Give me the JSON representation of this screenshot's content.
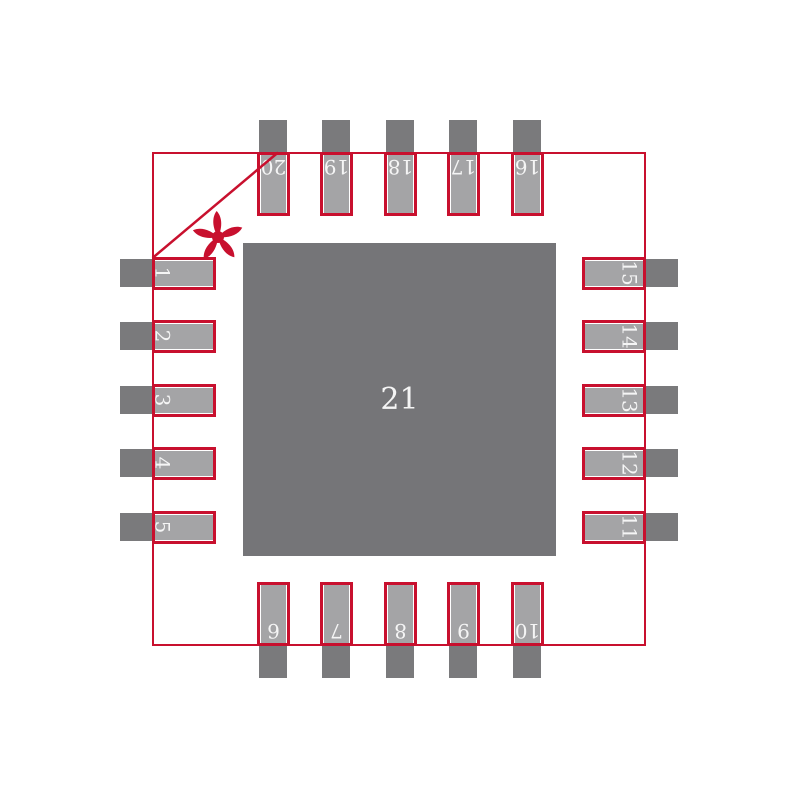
{
  "colors": {
    "accent_red": "#C8102E",
    "pad_fill": "#A4A4A6",
    "copper_dark": "#7A7A7C",
    "thermal_pad_fill": "#757578",
    "pad_number_text": "#F5F5F5",
    "background": "#FFFFFF"
  },
  "center_pad": {
    "label": "21"
  },
  "pin1_marker": {
    "type": "asterisk"
  },
  "pads": [
    {
      "number": "1",
      "side": "left",
      "slot": 0
    },
    {
      "number": "2",
      "side": "left",
      "slot": 1
    },
    {
      "number": "3",
      "side": "left",
      "slot": 2
    },
    {
      "number": "4",
      "side": "left",
      "slot": 3
    },
    {
      "number": "5",
      "side": "left",
      "slot": 4
    },
    {
      "number": "6",
      "side": "bottom",
      "slot": 0
    },
    {
      "number": "7",
      "side": "bottom",
      "slot": 1
    },
    {
      "number": "8",
      "side": "bottom",
      "slot": 2
    },
    {
      "number": "9",
      "side": "bottom",
      "slot": 3
    },
    {
      "number": "10",
      "side": "bottom",
      "slot": 4
    },
    {
      "number": "11",
      "side": "right",
      "slot": 4
    },
    {
      "number": "12",
      "side": "right",
      "slot": 3
    },
    {
      "number": "13",
      "side": "right",
      "slot": 2
    },
    {
      "number": "14",
      "side": "right",
      "slot": 1
    },
    {
      "number": "15",
      "side": "right",
      "slot": 0
    },
    {
      "number": "16",
      "side": "top",
      "slot": 4
    },
    {
      "number": "17",
      "side": "top",
      "slot": 3
    },
    {
      "number": "18",
      "side": "top",
      "slot": 2
    },
    {
      "number": "19",
      "side": "top",
      "slot": 1
    },
    {
      "number": "20",
      "side": "top",
      "slot": 0
    }
  ]
}
